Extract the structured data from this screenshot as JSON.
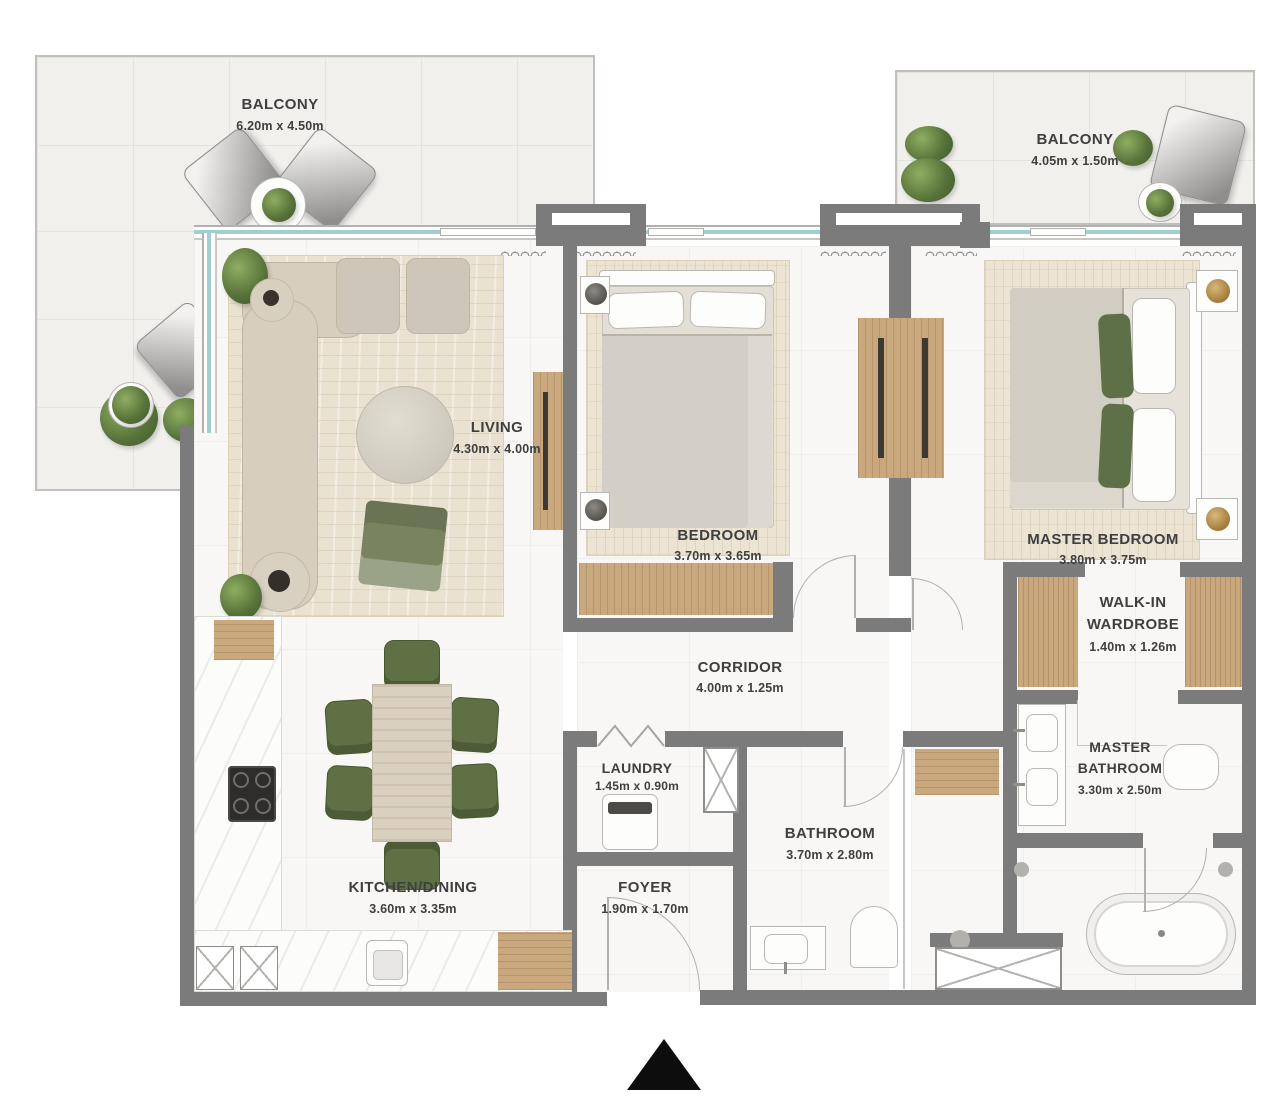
{
  "title": "Apartment Floor Plan",
  "rooms": {
    "balcony_top_left": {
      "name": "BALCONY",
      "dims": "6.20m x 4.50m"
    },
    "balcony_top_right": {
      "name": "BALCONY",
      "dims": "4.05m x 1.50m"
    },
    "living": {
      "name": "LIVING",
      "dims": "4.30m x 4.00m"
    },
    "bedroom": {
      "name": "BEDROOM",
      "dims": "3.70m x 3.65m"
    },
    "master_bedroom": {
      "name": "MASTER BEDROOM",
      "dims": "3.80m x 3.75m"
    },
    "walk_in_wardrobe": {
      "line1": "WALK-IN",
      "line2": "WARDROBE",
      "dims": "1.40m x 1.26m"
    },
    "corridor": {
      "name": "CORRIDOR",
      "dims": "4.00m x 1.25m"
    },
    "laundry": {
      "name": "LAUNDRY",
      "dims": "1.45m x 0.90m"
    },
    "bathroom": {
      "name": "BATHROOM",
      "dims": "3.70m x 2.80m"
    },
    "master_bathroom": {
      "line1": "MASTER",
      "line2": "BATHROOM",
      "dims": "3.30m x 2.50m"
    },
    "kitchen_dining": {
      "name": "KITCHEN/DINING",
      "dims": "3.60m x 3.35m"
    },
    "foyer": {
      "name": "FOYER",
      "dims": "1.90m x 1.70m"
    }
  },
  "colors": {
    "wall": "#7b7b7b",
    "wood": "#c9a87e",
    "glass": "#9fcfd1",
    "accent_green": "#5e7044",
    "label_text": "#3f3f3f",
    "balcony_floor": "#f1f0ed",
    "rug": "#eae2d0",
    "entrance_marker": "#0d0d0d"
  },
  "icons": {
    "entrance_marker": "north-entrance-triangle"
  }
}
